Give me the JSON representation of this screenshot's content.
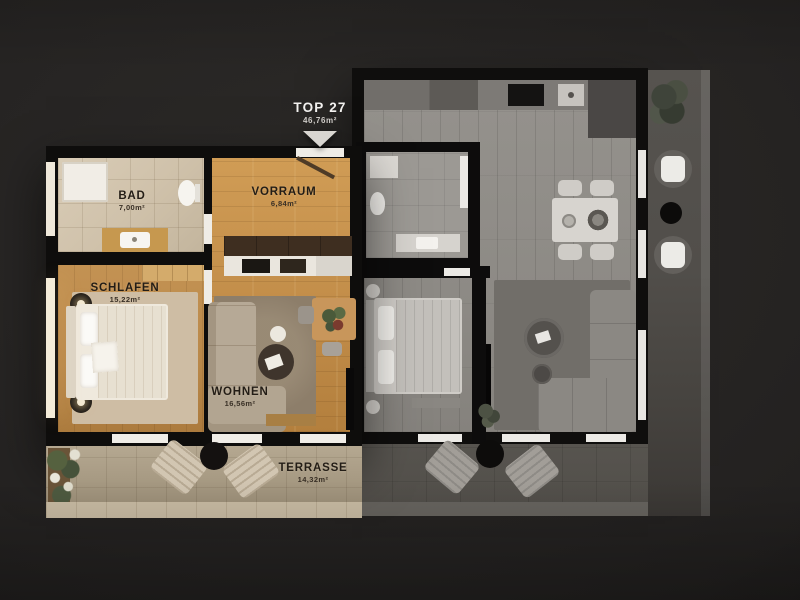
{
  "unit": {
    "name": "TOP 27",
    "area": "46,76m²"
  },
  "rooms": [
    {
      "id": "bad",
      "name": "BAD",
      "area": "7,00m²"
    },
    {
      "id": "vorraum",
      "name": "VORRAUM",
      "area": "6,84m²"
    },
    {
      "id": "schlafen",
      "name": "SCHLAFEN",
      "area": "15,22m²"
    },
    {
      "id": "wohnen",
      "name": "WOHNEN",
      "area": "16,56m²"
    },
    {
      "id": "terrasse",
      "name": "TERRASSE",
      "area": "14,32m²"
    }
  ],
  "icons": {
    "unit_pointer": "triangle-down"
  },
  "colors": {
    "background": "#242221",
    "walls": "#0e0d0c",
    "highlight_wood": "#c28d49",
    "bad_tile": "#cfc1aa",
    "terrace_tile": "#a3967f",
    "neighbor_floor": "#8d8a85",
    "label_dark": "#231d16",
    "label_light": "#f2f1ef"
  }
}
